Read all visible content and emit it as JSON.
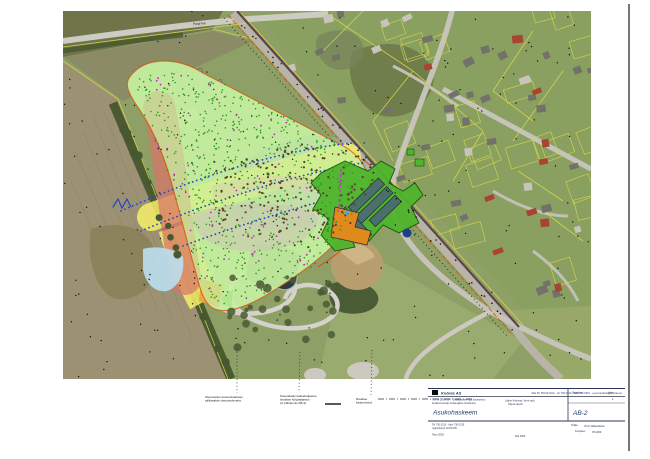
{
  "map": {
    "street_label": "Pargi tee"
  },
  "annotations": {
    "a1_line1": "Olemasolev kuivenduskraav,",
    "a1_line2": "säilitatakse olemasolevana",
    "a2_line1": "Kavandatav kaitsehaljastus,",
    "a2_line2": "istutatav kõrghaljastus",
    "a2_line3": "(vt põhijoonis AB-3)",
    "a3_line1": "Raudtee",
    "a3_line2": "kaitsevöönd"
  },
  "titleblock": {
    "logo_text": "Kobras AS",
    "address_line": "Riia 35, 50410 Tartu · tel 730 0310 · faks 730 0315 · e-post kobras@kobras.ee",
    "work_line1": "Töö nr 2009-134 · Detailplaneeringu koosseisus",
    "work_line2": "keskkonnamõju strateegiline hindamine",
    "location_line1": "Lääne-Virumaa, Vinni vald,",
    "location_line2": "Pajusti alevik",
    "title_main": "Asukohaskeem",
    "stage_label": "Staadium",
    "sheet_label": "Leht",
    "sheet_value": "1",
    "drawing_code": "AB-2",
    "office_line1": "Tel 730 0310 · faks 730 0315",
    "office_line2": "registrikood 10171636",
    "office_line3": "Tartu 2009",
    "center_bottom": "Mai 2009",
    "client_label": "Tellija",
    "client_value": "Vinni Vallavalitsus",
    "proj_label": "Kuupäev",
    "proj_value": "05.2009"
  },
  "colors": {
    "zone_green": "#c6f0a0",
    "zone_yellow": "#f6ee6a",
    "zone_red": "#d87468",
    "zone_magenta": "#dd66dd",
    "zone_pink": "#f2acb2",
    "zone_lavender": "#c7a6e4",
    "zone_grey_blue": "#9fb2b8",
    "zone_light_blue": "#badff0",
    "zone_orange": "#efa238",
    "dev_green": "#4fb52c",
    "dev_building": "#4b6f6d",
    "dev_orange": "#e08a1e",
    "boundary_red": "#d4520c",
    "cadastral_yellow": "#d8d848",
    "railway_dark": "#5f4450",
    "titleblock_ink": "#2c3856"
  }
}
